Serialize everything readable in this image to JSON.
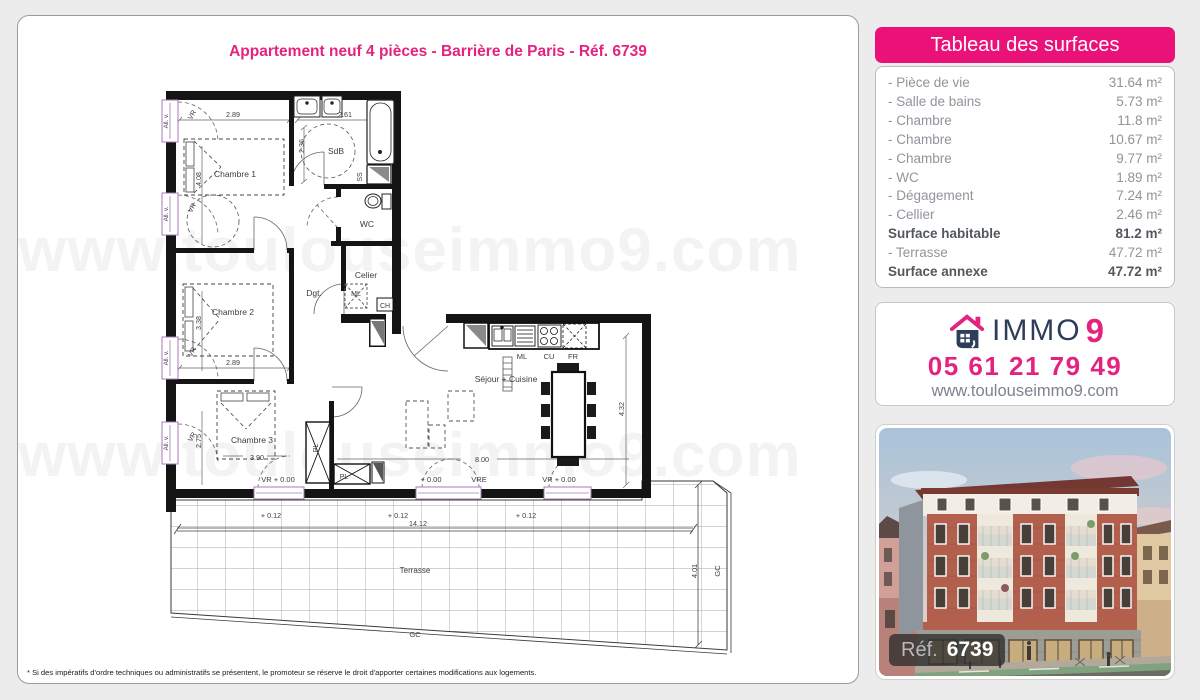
{
  "colors": {
    "accent": "#e4237f",
    "header_bg": "#ea1178",
    "navy": "#2e3d59",
    "window_violet": "#a87bb5"
  },
  "header": {
    "title": "Appartement neuf 4 pièces - Barrière de Paris - Réf. 6739"
  },
  "watermark": {
    "text": "www.toulouseimmo9.com"
  },
  "surfaces": {
    "header": "Tableau des surfaces",
    "rows": [
      {
        "label": "- Pièce de vie",
        "value": "31.64 m²"
      },
      {
        "label": "- Salle de bains",
        "value": "5.73 m²"
      },
      {
        "label": "- Chambre",
        "value": "11.8 m²"
      },
      {
        "label": "- Chambre",
        "value": "10.67 m²"
      },
      {
        "label": "- Chambre",
        "value": "9.77 m²"
      },
      {
        "label": "- WC",
        "value": "1.89 m²"
      },
      {
        "label": "- Dégagement",
        "value": "7.24 m²"
      },
      {
        "label": "- Cellier",
        "value": "2.46 m²"
      },
      {
        "label": "Surface habitable",
        "value": "81.2 m²"
      },
      {
        "label": "- Terrasse",
        "value": "47.72 m²"
      },
      {
        "label": "Surface annexe",
        "value": "47.72 m²"
      }
    ]
  },
  "agency": {
    "brand_immo": "IMMO",
    "brand_9": "9",
    "phone": "05 61 21 79 49",
    "website": "www.toulouseimmo9.com"
  },
  "photo": {
    "ref_label": "Réf.",
    "ref_number": "6739"
  },
  "footnote": {
    "text": "* Si des impératifs d'ordre techniques ou administratifs se présentent, le promoteur se réserve le droit d'apporter certaines modifications aux logements."
  },
  "plan": {
    "rooms": {
      "chambre1": "Chambre 1",
      "sdb": "SdB",
      "wc": "WC",
      "cellier": "Celier",
      "dgt": "Dgt.",
      "chambre2": "Chambre 2",
      "chambre3": "Chambre 3",
      "sejour": "Séjour + Cuisine",
      "terrasse": "Terrasse"
    },
    "dims": {
      "c1_w": "2.89",
      "c1_h": "4.08",
      "sdb_w": "2.61",
      "sdb_h": "2.36",
      "c2_h": "3.38",
      "c2_w": "2.89",
      "c3_h": "2.75",
      "c3_w": "3.90",
      "sej_w": "8.00",
      "sej_h": "4.32",
      "ter_w": "14.12",
      "ter_h": "4.01",
      "lvl_p012": "+ 0.12",
      "lvl_p000": "+ 0.00",
      "vr000": "VR + 0.00",
      "vre": "VRE"
    },
    "tags": {
      "ss": "SS",
      "ml": "ML",
      "ch": "CH",
      "pl": "PL",
      "cu": "CU",
      "fr": "FR",
      "gc": "GC",
      "allv": "All. v.",
      "vr": "VR"
    }
  }
}
